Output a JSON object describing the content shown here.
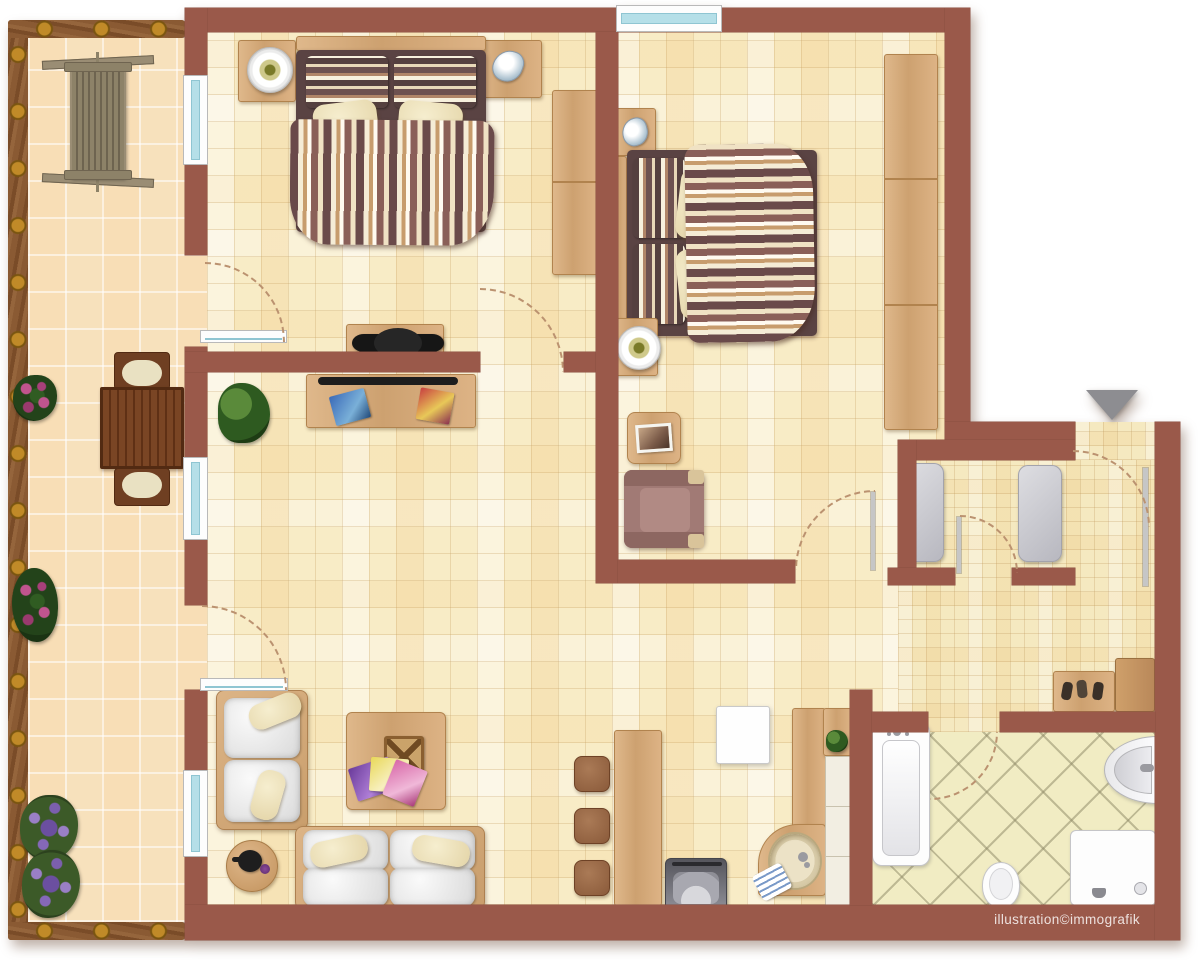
{
  "watermark": "illustration©immografik",
  "entrance_marker": "down-arrow",
  "palette": {
    "wall": "#9a594a",
    "floor_main": "#f8ecc6",
    "floor_balcony": "#f7e1bc",
    "floor_hall": "#f5e9c0",
    "floor_bath": "#f1ecc3",
    "wood": "#d9b183",
    "wood_dark": "#6f3f22",
    "window_glass": "#b5dfe8",
    "fixture_white": "#fdfdfd",
    "mat_gray": "#c9c9ce",
    "arrow_gray": "#8d8d91"
  },
  "rooms": [
    {
      "id": "balcony",
      "items": [
        "wood-railing",
        "porch-swing",
        "dining-table",
        "dining-chair-top",
        "dining-chair-bottom",
        "flower-pot-1",
        "flower-pot-2",
        "lavender-bush-1",
        "lavender-bush-2"
      ]
    },
    {
      "id": "bedroom-1",
      "items": [
        "double-bed",
        "striped-duvet",
        "striped-headboard-cushions",
        "pillows",
        "nightstand-with-lamp",
        "nightstand-with-shell",
        "wardrobe",
        "dressing-desk",
        "office-chair",
        "balcony-door",
        "window"
      ]
    },
    {
      "id": "bedroom-2",
      "items": [
        "double-bed",
        "striped-duvet",
        "striped-headboard-cushions",
        "pillows",
        "nightstand-with-shell",
        "nightstand-with-lamp",
        "tall-wardrobe",
        "photo-side-table",
        "armchair",
        "window"
      ]
    },
    {
      "id": "living-area",
      "items": [
        "desk-with-magazines",
        "potted-plant",
        "coffee-table",
        "magazine-basket",
        "magazine-fan",
        "round-side-table",
        "teapot",
        "two-seat-sofa",
        "three-seat-sofa",
        "balcony-door",
        "windows"
      ]
    },
    {
      "id": "kitchen",
      "items": [
        "bar-counter",
        "bar-stools",
        "fridge",
        "l-shaped-counter",
        "upper-cabinet",
        "white-cabinets",
        "round-sink",
        "stove",
        "small-plant",
        "towel"
      ]
    },
    {
      "id": "hallway",
      "items": [
        "closet-mat-1",
        "closet-mat-2",
        "shoe-bench",
        "shoes",
        "cabinet",
        "entrance-door"
      ]
    },
    {
      "id": "bathroom",
      "items": [
        "bathtub",
        "toilet",
        "shower",
        "washbasin"
      ]
    }
  ]
}
